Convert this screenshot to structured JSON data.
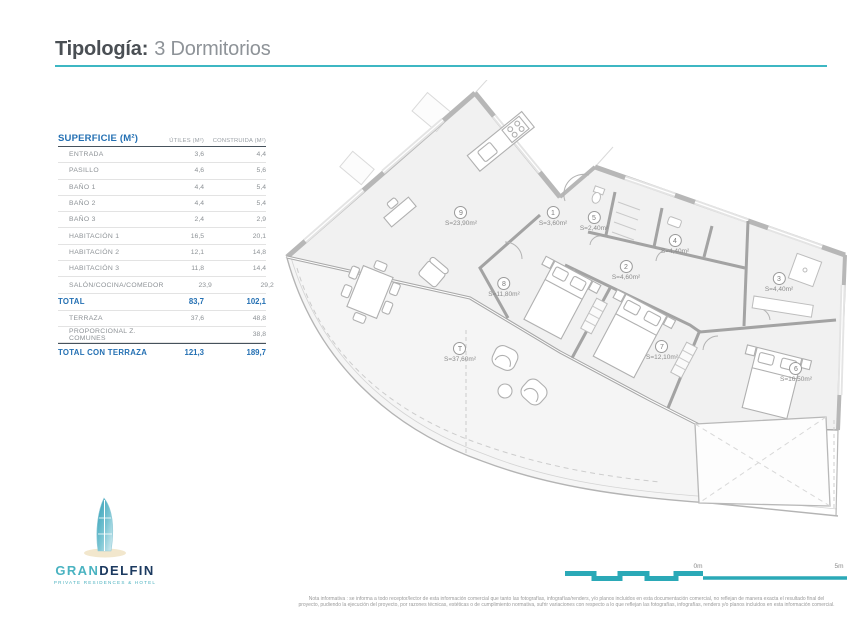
{
  "header": {
    "title_label": "Tipología:",
    "title_value": "3 Dormitorios"
  },
  "surface_table": {
    "title": "SUPERFICIE (M²)",
    "columns": [
      "ÚTILES (M²)",
      "CONSTRUIDA (M²)"
    ],
    "rows": [
      {
        "label": "ENTRADA",
        "utiles": "3,6",
        "construida": "4,4"
      },
      {
        "label": "PASILLO",
        "utiles": "4,6",
        "construida": "5,6"
      },
      {
        "label": "BAÑO 1",
        "utiles": "4,4",
        "construida": "5,4"
      },
      {
        "label": "BAÑO 2",
        "utiles": "4,4",
        "construida": "5,4"
      },
      {
        "label": "BAÑO 3",
        "utiles": "2,4",
        "construida": "2,9"
      },
      {
        "label": "HABITACIÓN 1",
        "utiles": "16,5",
        "construida": "20,1"
      },
      {
        "label": "HABITACIÓN 2",
        "utiles": "12,1",
        "construida": "14,8"
      },
      {
        "label": "HABITACIÓN 3",
        "utiles": "11,8",
        "construida": "14,4"
      },
      {
        "label": "SALÓN/COCINA/COMEDOR",
        "utiles": "23,9",
        "construida": "29,2"
      }
    ],
    "total": {
      "label": "TOTAL",
      "utiles": "83,7",
      "construida": "102,1"
    },
    "terrace_rows": [
      {
        "label": "TERRAZA",
        "utiles": "37,6",
        "construida": "48,8"
      },
      {
        "label": "PROPORCIONAL Z. COMUNES",
        "utiles": "",
        "construida": "38,8"
      }
    ],
    "grand_total": {
      "label": "TOTAL CON TERRAZA",
      "utiles": "121,3",
      "construida": "189,7"
    }
  },
  "floorplan": {
    "labels": [
      {
        "num": "9",
        "area": "S=23,90m²"
      },
      {
        "num": "1",
        "area": "S=3,60m²"
      },
      {
        "num": "5",
        "area": "S=2,40m²"
      },
      {
        "num": "8",
        "area": "S=11,80m²"
      },
      {
        "num": "4",
        "area": "S=4,40m²"
      },
      {
        "num": "2",
        "area": "S=4,60m²"
      },
      {
        "num": "3",
        "area": "S=4,40m²"
      },
      {
        "num": "7",
        "area": "S=12,10m²"
      },
      {
        "num": "6",
        "area": "S=16,50m²"
      },
      {
        "num": "T",
        "area": "S=37,60m²"
      }
    ]
  },
  "logo": {
    "name_part1": "GRAN",
    "name_part2": "DELFIN",
    "tagline": "PRIVATE RESIDENCES & HOTEL"
  },
  "scalebar": {
    "zero_label": "0m",
    "end_label": "5m"
  },
  "disclaimer": {
    "line1": "Nota informativa : se informa a todo receptor/lector de esta información comercial que tanto las fotografías, infografías/renders, y/o planos incluidos en esta documentación comercial, no reflejan de manera exacta el resultado final del",
    "line2": "proyecto, pudiendo la ejecución del proyecto, por razones técnicas, estéticas o de cumplimiento normativa, sufrir variaciones con respecto a lo que reflejan las fotografías, infografías, renders y/o planos incluidos en esta información comercial."
  },
  "colors": {
    "accent_teal": "#3db7c3",
    "table_blue": "#2470b3"
  }
}
